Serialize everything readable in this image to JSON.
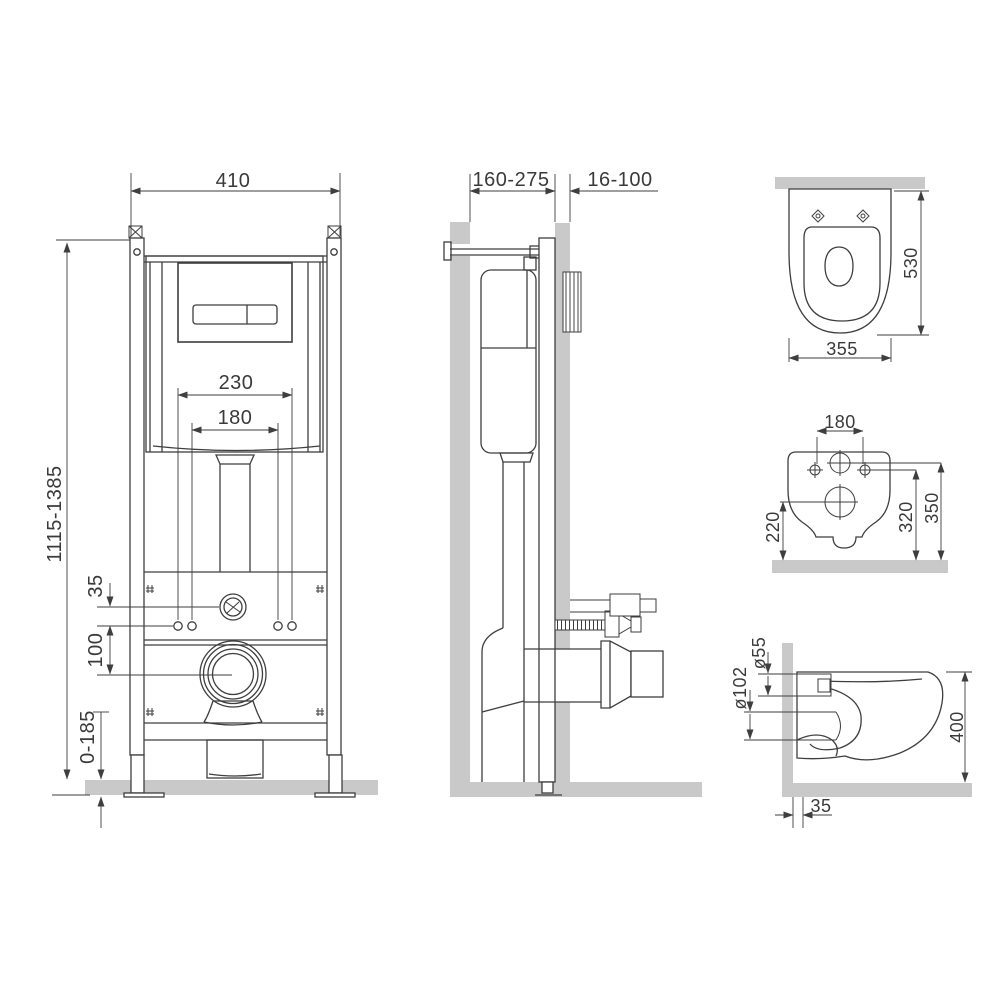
{
  "views": {
    "frame_front": {
      "dims": {
        "width": "410",
        "height_range": "1115-1385",
        "upper_hole_spacing": "230",
        "lower_hole_spacing": "180",
        "valve_offset": "35",
        "drain_offset": "100",
        "foot_adjust_range": "0-185"
      }
    },
    "frame_side": {
      "dims": {
        "frame_depth_range": "160-275",
        "finish_wall_thickness": "16-100"
      }
    },
    "bowl_top": {
      "dims": {
        "bowl_length": "530",
        "bowl_width": "355"
      }
    },
    "bowl_rear": {
      "dims": {
        "mount_hole_spacing": "180",
        "drain_center_height": "220",
        "mount_hole_height": "320",
        "inlet_center_height": "350"
      }
    },
    "bowl_side": {
      "dims": {
        "inlet_diameter": "ø55",
        "outlet_diameter": "ø102",
        "bowl_height": "400",
        "outlet_wall_offset": "35"
      }
    }
  },
  "colors": {
    "line": "#3e3e3e",
    "surface_gray": "#c9c9c9",
    "background": "#ffffff"
  }
}
